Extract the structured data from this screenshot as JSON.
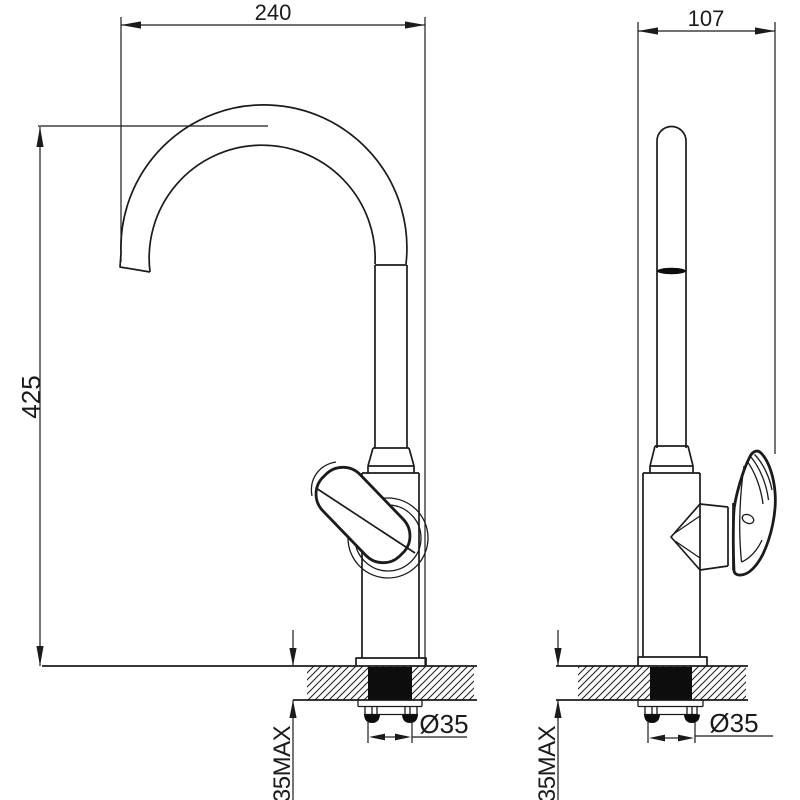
{
  "drawing": {
    "type": "technical-dimension-drawing",
    "subject": "kitchen sink mixer faucet, front and side installation views",
    "line_color": "#1b1b1b",
    "background": "#ffffff",
    "dimensions": {
      "spout_reach": "240",
      "side_depth": "107",
      "overall_height": "425",
      "hole_diameter_front": "Ø35",
      "hole_diameter_side": "Ø35",
      "counter_thickness_front": "35MAX",
      "counter_thickness_side": "35MAX"
    }
  }
}
